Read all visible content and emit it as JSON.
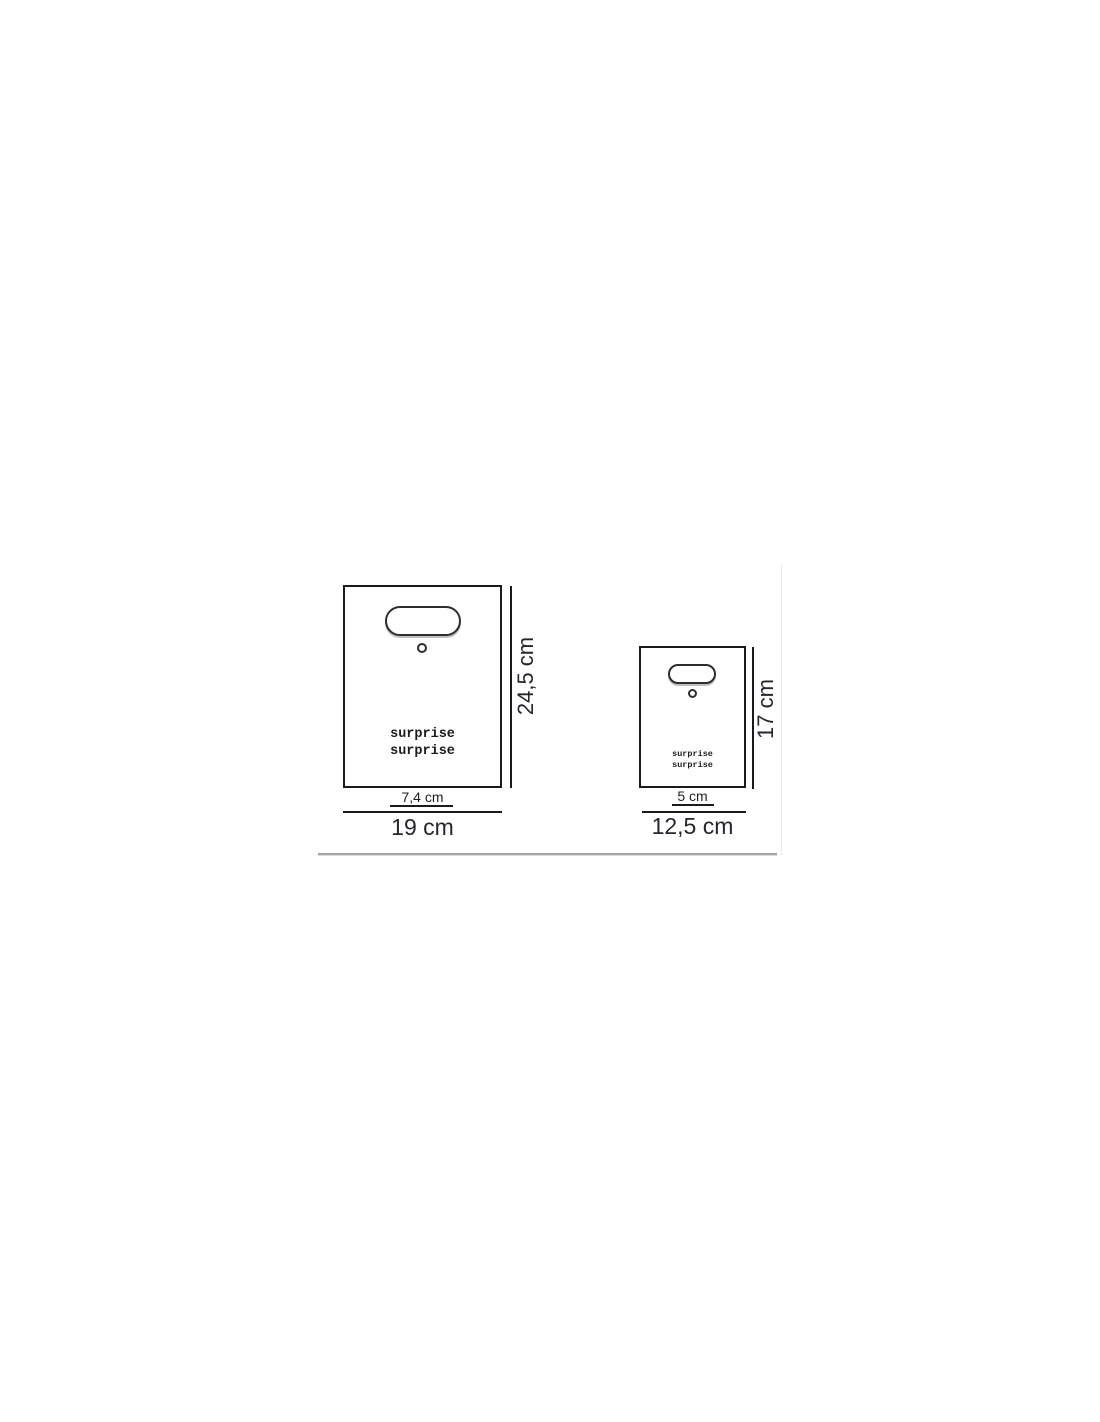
{
  "title": "gift-bag-dimension-diagram",
  "colors": {
    "background": "#ffffff",
    "outline": "#1a1a1a",
    "label_text": "#26262e",
    "print_text": "#1c1c1c",
    "divider": "#a5a5a7",
    "column_edge": "#e7e7e9",
    "handle_shadow": "#c0c0c0"
  },
  "bags": {
    "large": {
      "print_line1": "surprise",
      "print_line2": "surprise",
      "height_label": "24,5 cm",
      "handle_width_label": "7,4 cm",
      "width_label": "19 cm"
    },
    "small": {
      "print_line1": "surprise",
      "print_line2": "surprise",
      "height_label": "17 cm",
      "handle_width_label": "5 cm",
      "width_label": "12,5 cm"
    }
  }
}
